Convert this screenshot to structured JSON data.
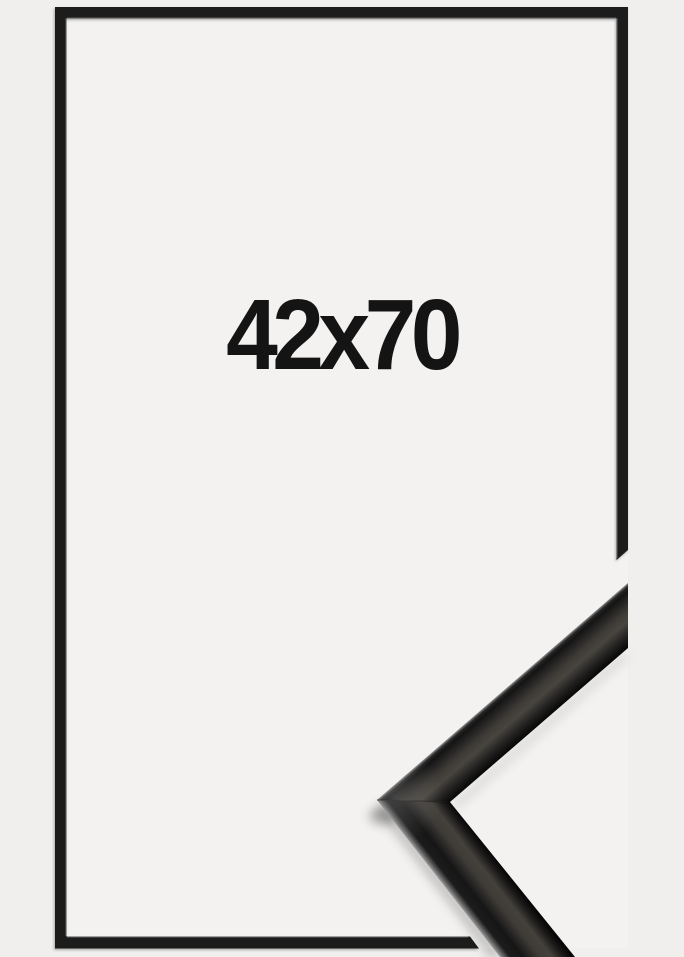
{
  "frame_product": {
    "size_label": "42x70",
    "colors": {
      "background": "#f0efed",
      "picture_area": "#f3f2f0",
      "frame": "#1d1d1d",
      "frame_inner_highlight": "#8a8a8a",
      "label_text": "#141414",
      "sample_rim_light": "#9c9c9c",
      "sample_sheen": "#48453f",
      "sample_dark": "#060606"
    }
  }
}
